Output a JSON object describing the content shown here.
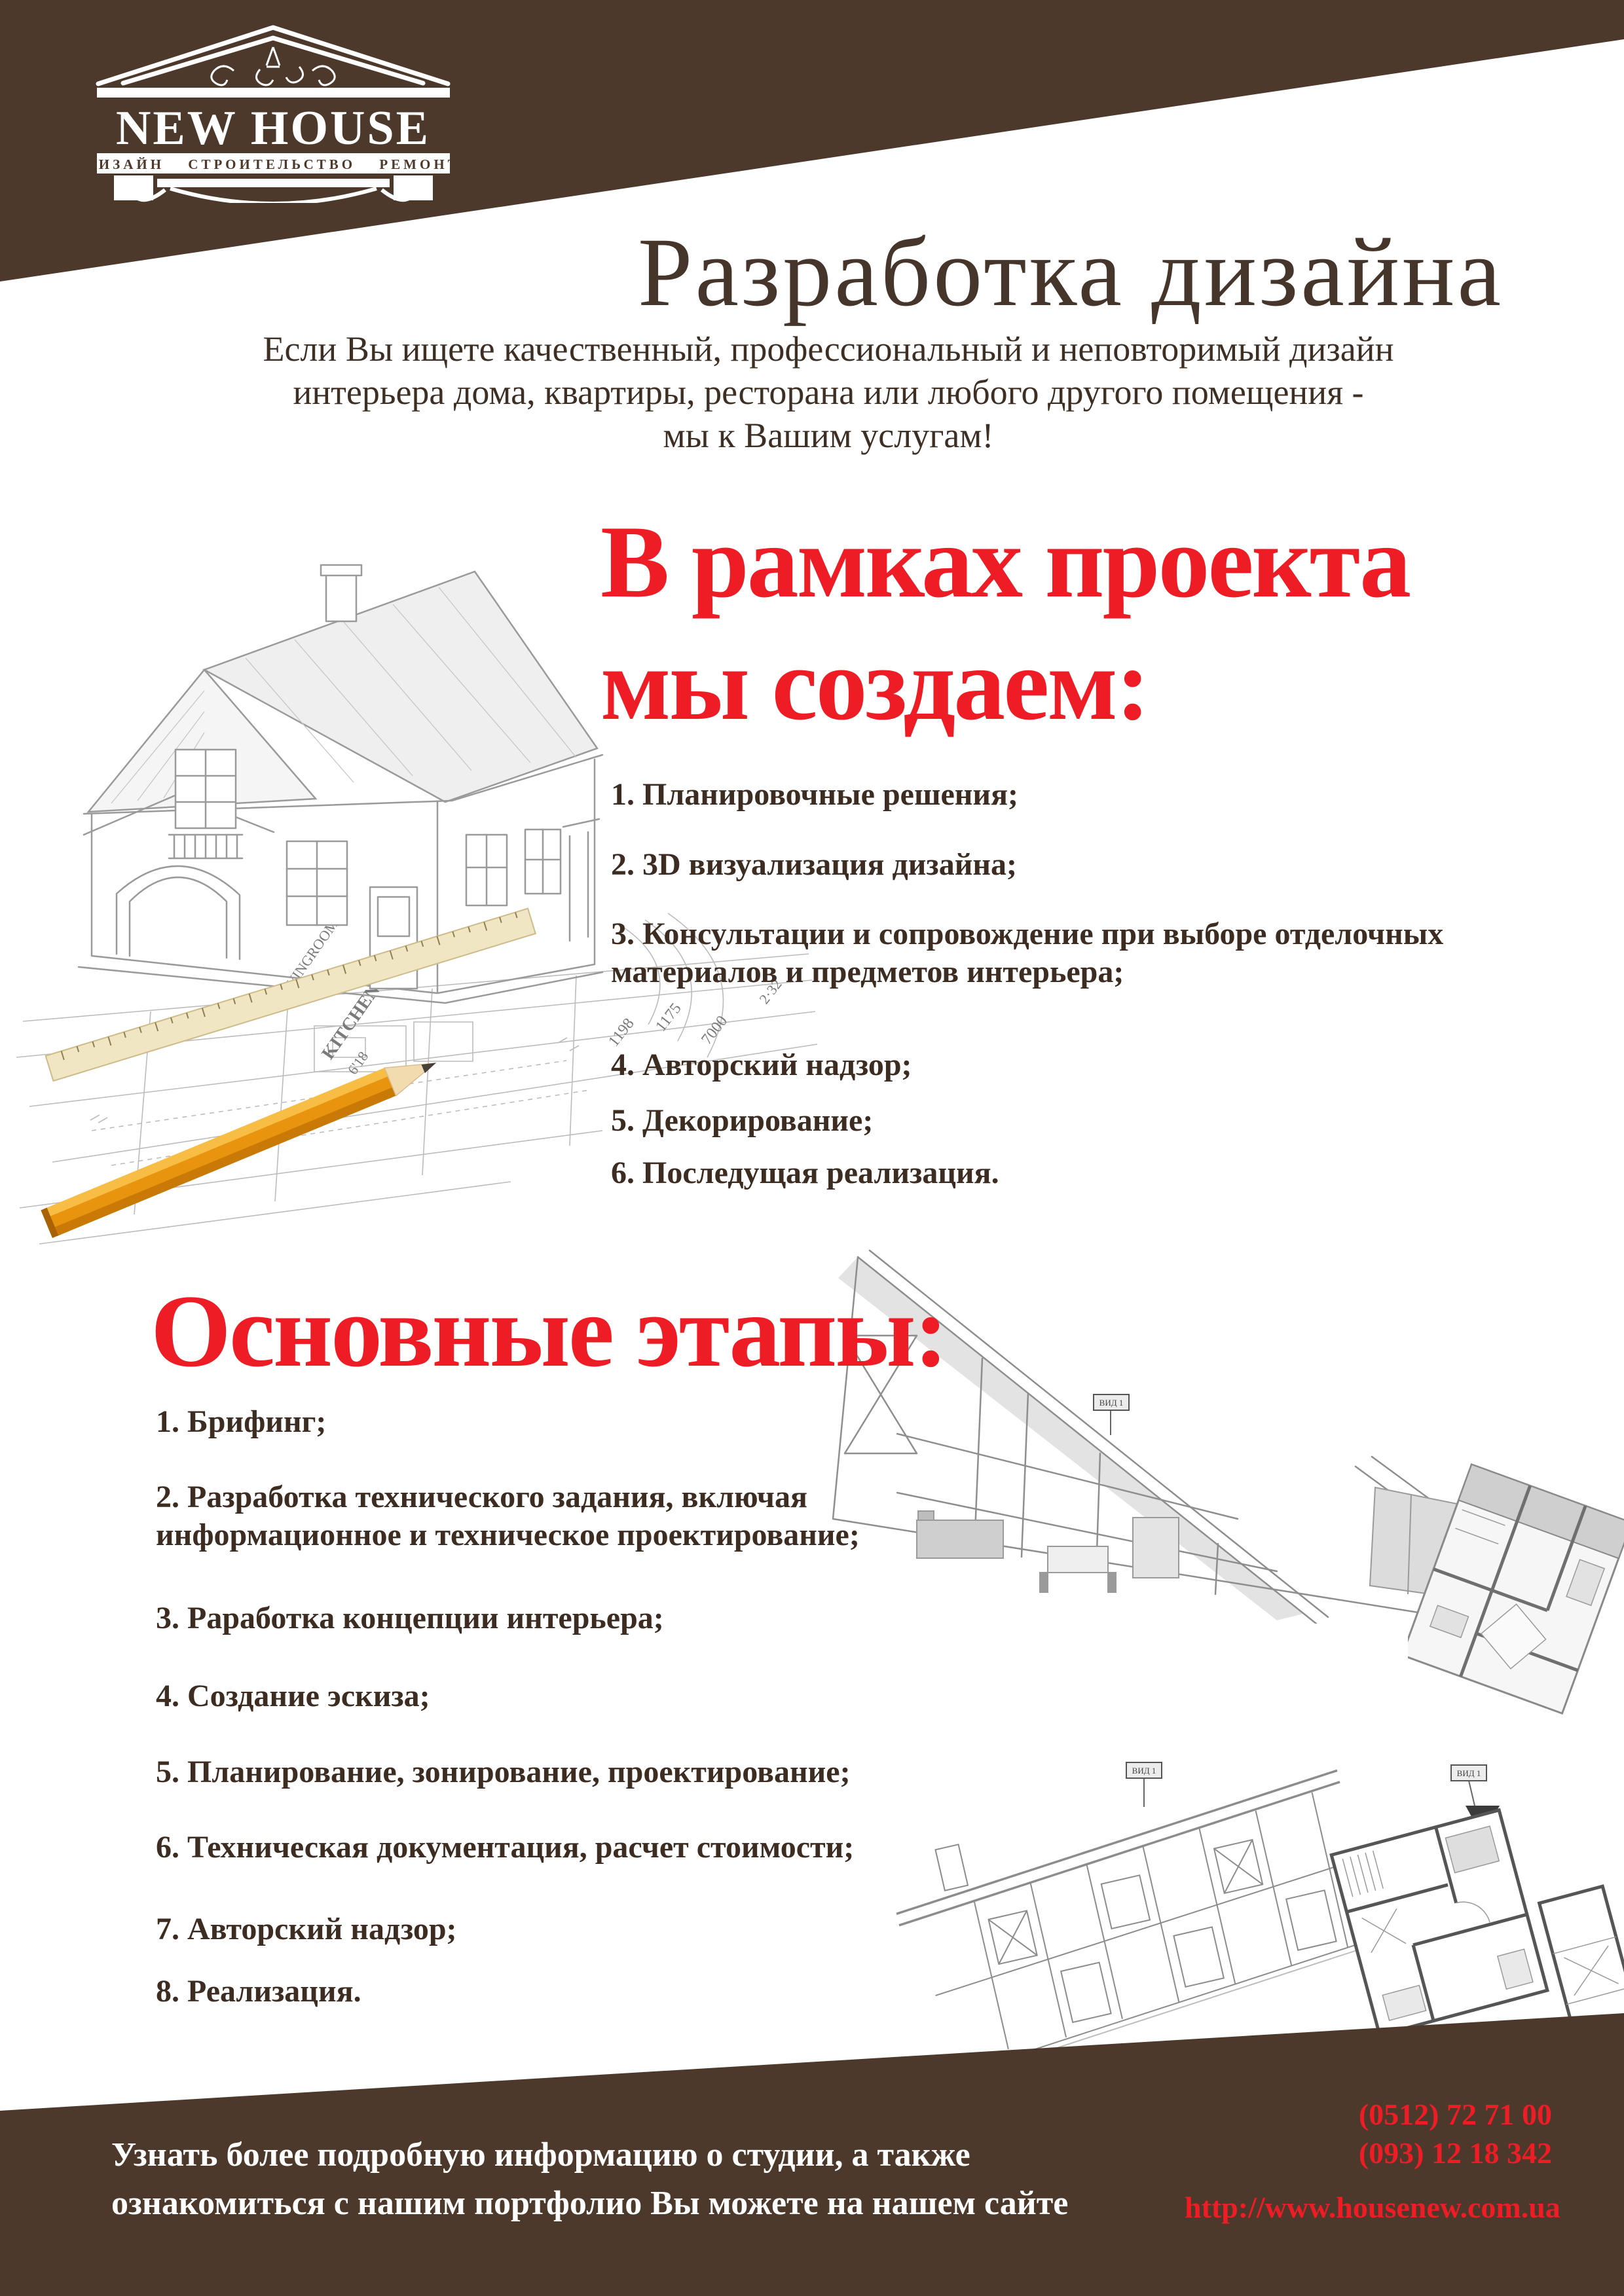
{
  "page": {
    "brand_brown": "#4C392B",
    "accent_red": "#EE1C25",
    "text_brown": "#3C2C21"
  },
  "logo": {
    "name": "NEW HOUSE",
    "tagline": "ДИЗАЙН СТРОИТЕЛЬСТВО РЕМОНТ"
  },
  "header": {
    "title": "Разработка дизайна",
    "subtitle_line1": "Если Вы ищете качественный, профессиональный и неповторимый дизайн",
    "subtitle_line2": "интерьера дома, квартиры, ресторана или любого другого помещения -",
    "subtitle_line3": "мы к Вашим услугам!"
  },
  "create_section": {
    "heading_line1": "В рамках проекта",
    "heading_line2": "мы создаем:",
    "items": [
      "1. Планировочные решения;",
      "2. 3D визуализация дизайна;",
      "3. Консультации и сопровождение при выборе отделочных материалов и предметов интерьера;",
      "4. Авторский надзор;",
      "5. Декорирование;",
      "6. Последущая реализация."
    ]
  },
  "stages_section": {
    "heading": "Основные этапы:",
    "items": [
      "1. Брифинг;",
      "2. Разработка технического задания, включая информационное и техническое проектирование;",
      "3. Раработка концепции интерьера;",
      "4. Создание эскиза;",
      "5. Планирование, зонирование, проектирование;",
      "6. Техническая документация, расчет стоимости;",
      "7. Авторский надзор;",
      "8. Реализация."
    ]
  },
  "footer": {
    "note_line1": "Узнать более подробную информацию о студии, а также",
    "note_line2": "ознакомиться с нашим портфолио Вы можете на нашем сайте",
    "phone1": "(0512) 72 71 00",
    "phone2": "(093) 12 18 342",
    "website": "http://www.housenew.com.ua"
  },
  "sketch_labels": {
    "kitchen": "KITCHEN",
    "kitchen_size": "6'18",
    "livingroom": "LIVINGROOM",
    "dim1": "1198",
    "dim2": "1175",
    "dim3": "7000",
    "dim4": "2·32",
    "view_flag": "ВИД 1"
  }
}
